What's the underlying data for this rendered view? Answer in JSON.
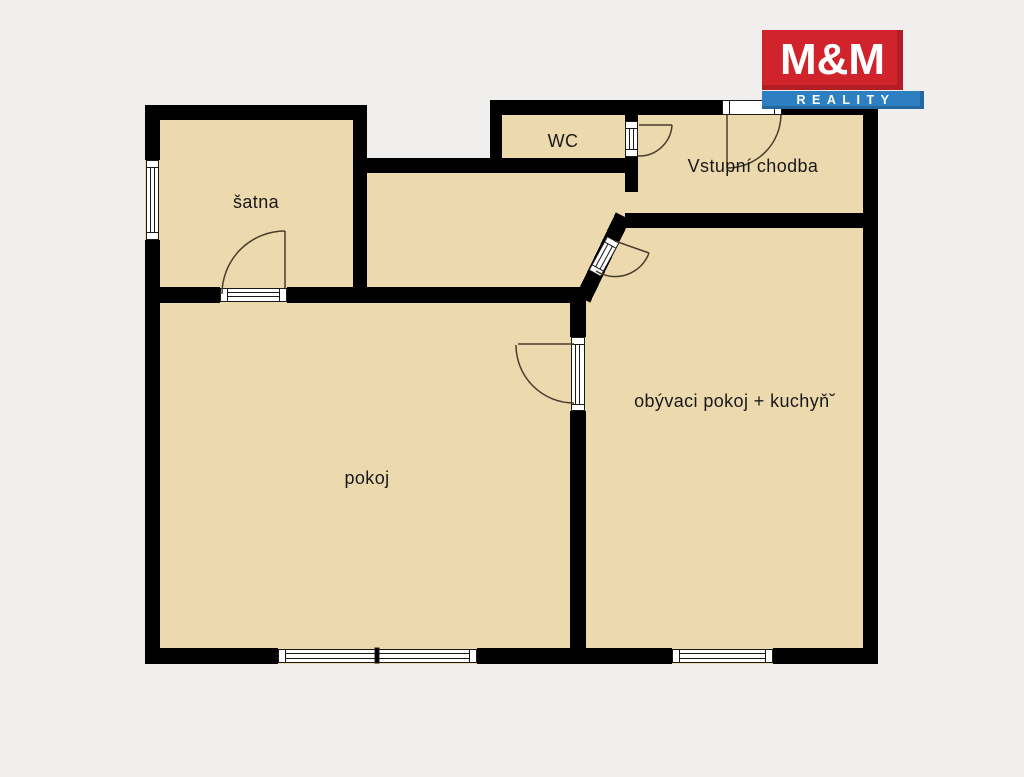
{
  "page": {
    "background_color": "#f0efed"
  },
  "logo": {
    "top_text": "M&M",
    "bottom_text": "REALITY",
    "red_color": "#d0232b",
    "blue_color": "#2e7fc2",
    "text_color": "#ffffff"
  },
  "floorplan": {
    "wall_color": "#000000",
    "floor_color": "#ecd9ae",
    "door_swing_color": "#4a3d2c",
    "rooms": [
      {
        "id": "satna",
        "label": "šatna"
      },
      {
        "id": "wc",
        "label": "WC"
      },
      {
        "id": "vstupni-chodba",
        "label": "Vstupní chodba"
      },
      {
        "id": "pokoj",
        "label": "pokoj"
      },
      {
        "id": "obyvaci-pokoj-kuchyn",
        "label": "obývaci pokoj + kuchyň˘"
      }
    ]
  }
}
